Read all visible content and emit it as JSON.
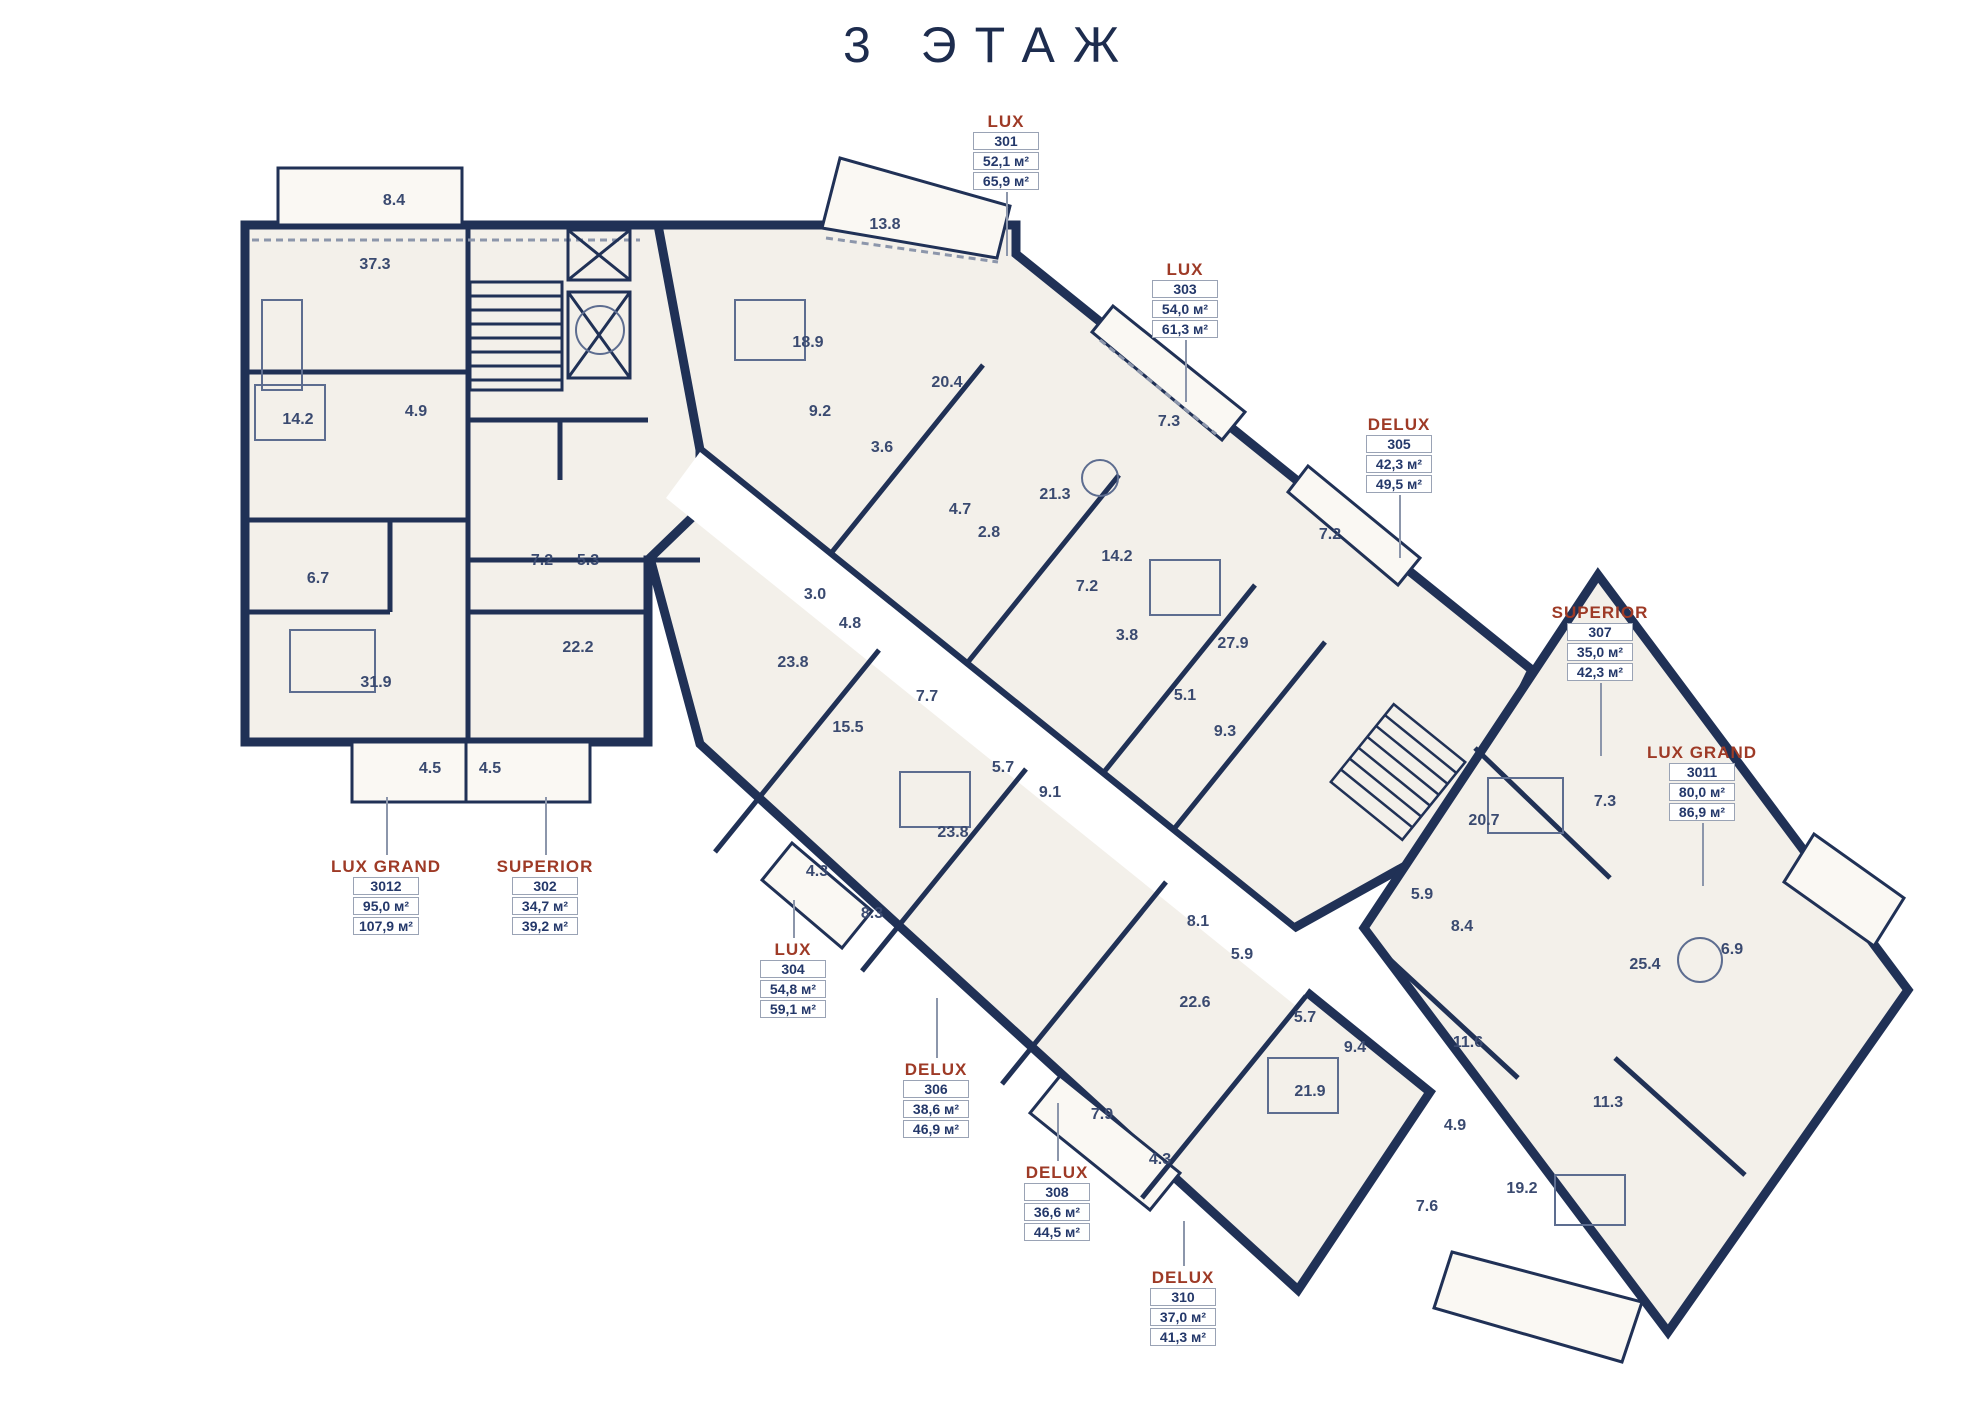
{
  "title": "3 ЭТАЖ",
  "area_unit": "м²",
  "colors": {
    "wall_navy": "#203156",
    "accent_red": "#9e3a26",
    "floor_fill": "#f3f0ea",
    "balcony_fill": "#faf8f3",
    "leader_gray": "#8c96ab",
    "room_text": "#3a4a70"
  },
  "units": [
    {
      "type": "LUX",
      "number": "301",
      "area1": "52,1 м²",
      "area2": "65,9 м²",
      "x": 1006,
      "y": 112,
      "leader": "down",
      "leader_len": 64
    },
    {
      "type": "LUX",
      "number": "303",
      "area1": "54,0 м²",
      "area2": "61,3 м²",
      "x": 1185,
      "y": 260,
      "leader": "down",
      "leader_len": 62
    },
    {
      "type": "DELUX",
      "number": "305",
      "area1": "42,3 м²",
      "area2": "49,5 м²",
      "x": 1399,
      "y": 415,
      "leader": "down",
      "leader_len": 63
    },
    {
      "type": "SUPERIOR",
      "number": "307",
      "area1": "35,0 м²",
      "area2": "42,3 м²",
      "x": 1600,
      "y": 603,
      "leader": "down",
      "leader_len": 73
    },
    {
      "type": "LUX GRAND",
      "number": "3011",
      "area1": "80,0 м²",
      "area2": "86,9 м²",
      "x": 1702,
      "y": 743,
      "leader": "down",
      "leader_len": 63
    },
    {
      "type": "LUX GRAND",
      "number": "3012",
      "area1": "95,0 м²",
      "area2": "107,9 м²",
      "x": 386,
      "y": 857,
      "leader": "up",
      "leader_len": 58
    },
    {
      "type": "SUPERIOR",
      "number": "302",
      "area1": "34,7 м²",
      "area2": "39,2 м²",
      "x": 545,
      "y": 857,
      "leader": "up",
      "leader_len": 58
    },
    {
      "type": "LUX",
      "number": "304",
      "area1": "54,8 м²",
      "area2": "59,1 м²",
      "x": 793,
      "y": 940,
      "leader": "up",
      "leader_len": 38
    },
    {
      "type": "DELUX",
      "number": "306",
      "area1": "38,6 м²",
      "area2": "46,9 м²",
      "x": 936,
      "y": 1060,
      "leader": "up",
      "leader_len": 60
    },
    {
      "type": "DELUX",
      "number": "308",
      "area1": "36,6 м²",
      "area2": "44,5 м²",
      "x": 1057,
      "y": 1163,
      "leader": "up",
      "leader_len": 58
    },
    {
      "type": "DELUX",
      "number": "310",
      "area1": "37,0 м²",
      "area2": "41,3 м²",
      "x": 1183,
      "y": 1268,
      "leader": "up",
      "leader_len": 45
    }
  ],
  "rooms": [
    {
      "v": "8.4",
      "x": 394,
      "y": 201
    },
    {
      "v": "37.3",
      "x": 375,
      "y": 265
    },
    {
      "v": "14.2",
      "x": 298,
      "y": 420
    },
    {
      "v": "4.9",
      "x": 416,
      "y": 412
    },
    {
      "v": "6.7",
      "x": 318,
      "y": 579
    },
    {
      "v": "31.9",
      "x": 376,
      "y": 683
    },
    {
      "v": "4.5",
      "x": 430,
      "y": 769
    },
    {
      "v": "4.5",
      "x": 490,
      "y": 769
    },
    {
      "v": "7.2",
      "x": 542,
      "y": 561
    },
    {
      "v": "5.3",
      "x": 588,
      "y": 561
    },
    {
      "v": "22.2",
      "x": 578,
      "y": 648
    },
    {
      "v": "13.8",
      "x": 885,
      "y": 225
    },
    {
      "v": "18.9",
      "x": 808,
      "y": 343
    },
    {
      "v": "9.2",
      "x": 820,
      "y": 412
    },
    {
      "v": "20.4",
      "x": 947,
      "y": 383
    },
    {
      "v": "3.6",
      "x": 882,
      "y": 448
    },
    {
      "v": "7.3",
      "x": 1169,
      "y": 422
    },
    {
      "v": "4.7",
      "x": 960,
      "y": 510
    },
    {
      "v": "2.8",
      "x": 989,
      "y": 533
    },
    {
      "v": "21.3",
      "x": 1055,
      "y": 495
    },
    {
      "v": "14.2",
      "x": 1117,
      "y": 557
    },
    {
      "v": "7.2",
      "x": 1087,
      "y": 587
    },
    {
      "v": "3.8",
      "x": 1127,
      "y": 636
    },
    {
      "v": "7.2",
      "x": 1330,
      "y": 535
    },
    {
      "v": "27.9",
      "x": 1233,
      "y": 644
    },
    {
      "v": "5.1",
      "x": 1185,
      "y": 696
    },
    {
      "v": "9.3",
      "x": 1225,
      "y": 732
    },
    {
      "v": "3.0",
      "x": 815,
      "y": 595
    },
    {
      "v": "4.8",
      "x": 850,
      "y": 624
    },
    {
      "v": "23.8",
      "x": 793,
      "y": 663
    },
    {
      "v": "7.7",
      "x": 927,
      "y": 697
    },
    {
      "v": "15.5",
      "x": 848,
      "y": 728
    },
    {
      "v": "5.7",
      "x": 1003,
      "y": 768
    },
    {
      "v": "9.1",
      "x": 1050,
      "y": 793
    },
    {
      "v": "23.8",
      "x": 953,
      "y": 833
    },
    {
      "v": "4.3",
      "x": 817,
      "y": 872
    },
    {
      "v": "8.3",
      "x": 872,
      "y": 914
    },
    {
      "v": "8.1",
      "x": 1198,
      "y": 922
    },
    {
      "v": "5.9",
      "x": 1242,
      "y": 955
    },
    {
      "v": "22.6",
      "x": 1195,
      "y": 1003
    },
    {
      "v": "7.9",
      "x": 1102,
      "y": 1115
    },
    {
      "v": "4.3",
      "x": 1160,
      "y": 1160
    },
    {
      "v": "5.7",
      "x": 1305,
      "y": 1018
    },
    {
      "v": "9.4",
      "x": 1355,
      "y": 1048
    },
    {
      "v": "21.9",
      "x": 1310,
      "y": 1092
    },
    {
      "v": "4.9",
      "x": 1455,
      "y": 1126
    },
    {
      "v": "7.6",
      "x": 1427,
      "y": 1207
    },
    {
      "v": "19.2",
      "x": 1522,
      "y": 1189
    },
    {
      "v": "20.7",
      "x": 1484,
      "y": 821
    },
    {
      "v": "7.3",
      "x": 1605,
      "y": 802
    },
    {
      "v": "5.9",
      "x": 1422,
      "y": 895
    },
    {
      "v": "8.4",
      "x": 1462,
      "y": 927
    },
    {
      "v": "11.6",
      "x": 1468,
      "y": 1043
    },
    {
      "v": "25.4",
      "x": 1645,
      "y": 965
    },
    {
      "v": "6.9",
      "x": 1732,
      "y": 950
    },
    {
      "v": "11.3",
      "x": 1608,
      "y": 1103
    }
  ]
}
